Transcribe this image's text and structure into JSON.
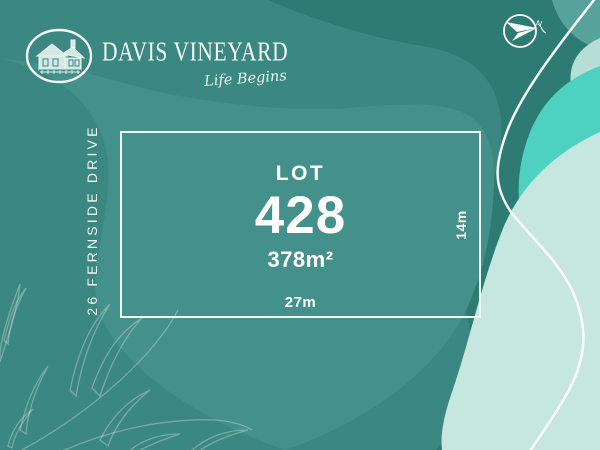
{
  "brand": {
    "name": "DAVIS VINEYARD",
    "tagline": "Life Begins"
  },
  "street": {
    "label": "26 FERNSIDE DRIVE"
  },
  "lot": {
    "label": "LOT",
    "number": "428",
    "area": "378m²",
    "frontage": "27m",
    "depth": "14m"
  },
  "compass": {
    "north_label": "N"
  },
  "icons": {
    "logo": "house-in-oval-icon",
    "compass": "north-arrow-compass-icon",
    "decoration": "leaf-line-art"
  },
  "colors": {
    "base_dark_teal": "#2E7B74",
    "mid_teal": "#3B8781",
    "panel_teal": "#44908A",
    "bright_aqua": "#4FD1C1",
    "light_mint": "#C5E7DF",
    "corner_teal": "#57A39B",
    "text_white": "#FFFFFF"
  }
}
